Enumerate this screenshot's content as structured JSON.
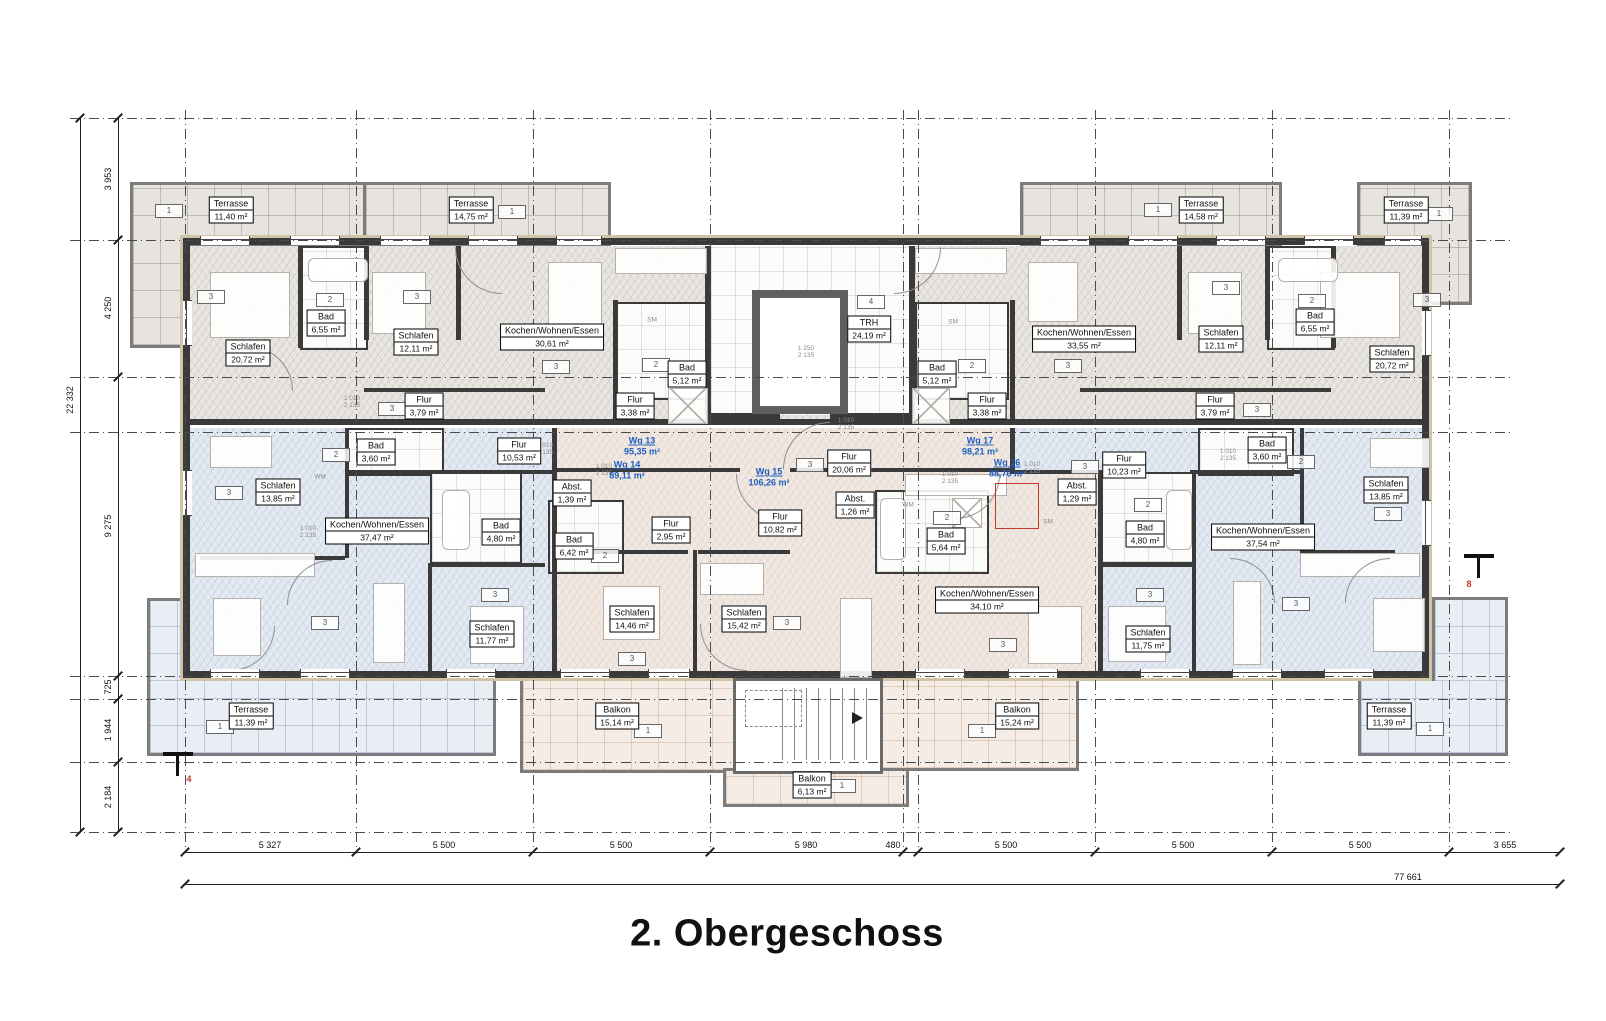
{
  "title": "2. Obergeschoss",
  "apartments": [
    {
      "id": "Wg 13",
      "area": "95,35 m²"
    },
    {
      "id": "Wg 14",
      "area": "89,11 m²"
    },
    {
      "id": "Wg 15",
      "area": "106,26 m²"
    },
    {
      "id": "Wg 16",
      "area": "88,76 m²"
    },
    {
      "id": "Wg 17",
      "area": "98,21 m²"
    }
  ],
  "stairwell": {
    "name": "TRH",
    "area": "24,19 m²"
  },
  "rooms": [
    {
      "name": "Schlafen",
      "area": "20,72 m²"
    },
    {
      "name": "Bad",
      "area": "6,55 m²"
    },
    {
      "name": "Schlafen",
      "area": "12,11 m²"
    },
    {
      "name": "Kochen/Wohnen/Essen",
      "area": "30,61 m²"
    },
    {
      "name": "Flur",
      "area": "3,79 m²"
    },
    {
      "name": "Flur",
      "area": "3,38 m²"
    },
    {
      "name": "Bad",
      "area": "5,12 m²"
    },
    {
      "name": "Bad",
      "area": "5,12 m²"
    },
    {
      "name": "Flur",
      "area": "3,38 m²"
    },
    {
      "name": "Kochen/Wohnen/Essen",
      "area": "33,55 m²"
    },
    {
      "name": "Schlafen",
      "area": "12,11 m²"
    },
    {
      "name": "Bad",
      "area": "6,55 m²"
    },
    {
      "name": "Schlafen",
      "area": "20,72 m²"
    },
    {
      "name": "Flur",
      "area": "3,79 m²"
    },
    {
      "name": "Bad",
      "area": "3,60 m²"
    },
    {
      "name": "Flur",
      "area": "10,53 m²"
    },
    {
      "name": "Schlafen",
      "area": "13,85 m²"
    },
    {
      "name": "Abst.",
      "area": "1,39 m²"
    },
    {
      "name": "Kochen/Wohnen/Essen",
      "area": "37,47 m²"
    },
    {
      "name": "Bad",
      "area": "4,80 m²"
    },
    {
      "name": "Schlafen",
      "area": "11,77 m²"
    },
    {
      "name": "Bad",
      "area": "6,42 m²"
    },
    {
      "name": "Flur",
      "area": "2,95 m²"
    },
    {
      "name": "Schlafen",
      "area": "14,46 m²"
    },
    {
      "name": "Schlafen",
      "area": "15,42 m²"
    },
    {
      "name": "Flur",
      "area": "10,82 m²"
    },
    {
      "name": "Abst.",
      "area": "1,26 m²"
    },
    {
      "name": "Bad",
      "area": "5,64 m²"
    },
    {
      "name": "Kochen/Wohnen/Essen",
      "area": "34,10 m²"
    },
    {
      "name": "Flur",
      "area": "20,06 m²"
    },
    {
      "name": "Flur",
      "area": "10,23 m²"
    },
    {
      "name": "Abst.",
      "area": "1,29 m²"
    },
    {
      "name": "Bad",
      "area": "4,80 m²"
    },
    {
      "name": "Bad",
      "area": "3,60 m²"
    },
    {
      "name": "Kochen/Wohnen/Essen",
      "area": "37,54 m²"
    },
    {
      "name": "Schlafen",
      "area": "11,75 m²"
    },
    {
      "name": "Schlafen",
      "area": "13,85 m²"
    }
  ],
  "outdoor": [
    {
      "name": "Terrasse",
      "area": "11,40 m²"
    },
    {
      "name": "Terrasse",
      "area": "14,75 m²"
    },
    {
      "name": "Terrasse",
      "area": "14,58 m²"
    },
    {
      "name": "Terrasse",
      "area": "11,39 m²"
    },
    {
      "name": "Terrasse",
      "area": "11,39 m²"
    },
    {
      "name": "Balkon",
      "area": "15,14 m²"
    },
    {
      "name": "Balkon",
      "area": "15,24 m²"
    },
    {
      "name": "Balkon",
      "area": "6,13 m²"
    },
    {
      "name": "Terrasse",
      "area": "11,39 m²"
    }
  ],
  "tags": {
    "outdoor": "1",
    "bath": "2",
    "room": "3",
    "stair": "4"
  },
  "door_dims": {
    "w": "1 010",
    "h": "2 135",
    "elevator_w": "1 250",
    "elevator_h": "2 135"
  },
  "appliances": {
    "wm": "WM",
    "sm": "SM"
  },
  "section_markers": {
    "left": "4",
    "right": "8"
  },
  "dimensions": {
    "left": [
      "3 953",
      "4 250",
      "9 275",
      "725",
      "1 944",
      "2 184"
    ],
    "left_total": "22 332",
    "bottom": [
      "5 327",
      "5 500",
      "5 500",
      "5 980",
      "480",
      "5 500",
      "5 500",
      "5 500",
      "3 655"
    ],
    "bottom_total": "77 661"
  },
  "colors": {
    "apartment_label_blue": "#1d5ec0",
    "marker_red": "#c0392b",
    "wall_dark": "#3a3a3a",
    "fill_top_grey": "#e9e6e2",
    "fill_blue": "#e4eaf2",
    "fill_pink": "#f0e8e2"
  }
}
